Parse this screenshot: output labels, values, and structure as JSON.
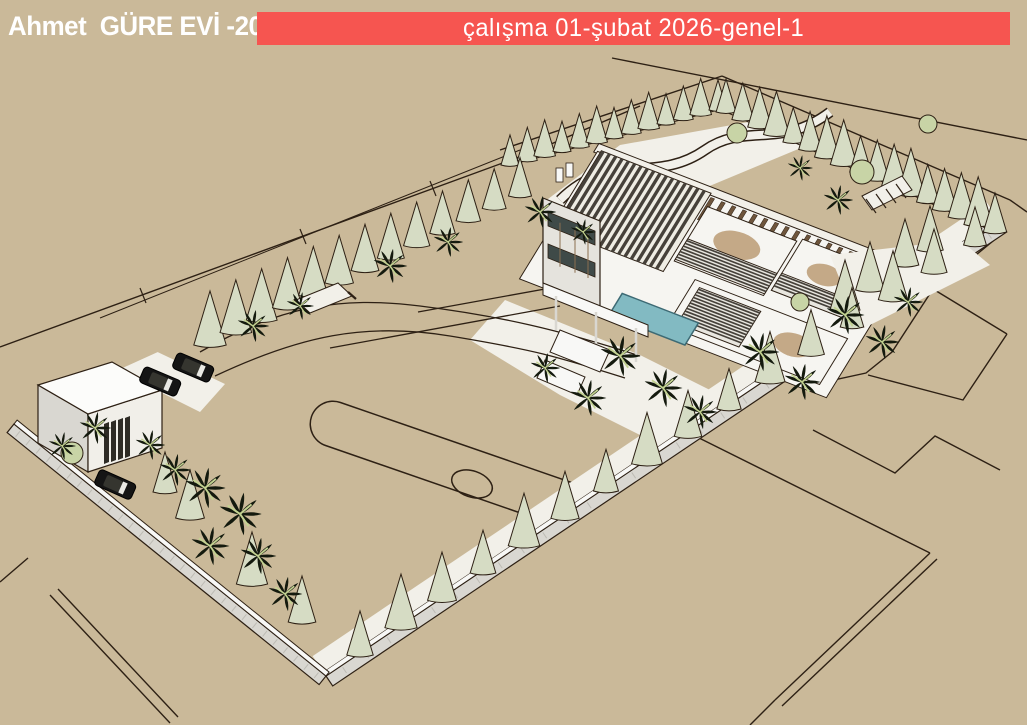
{
  "header": {
    "project_title": "Ahmet  GÜRE EVİ -2026",
    "sheet_title": "çalışma 01-şubat 2026-genel-1"
  },
  "colors": {
    "background": "#cab999",
    "banner_red": "#f65550",
    "line": "#2d2014",
    "wall_white": "#f8f8f6",
    "wall_shade": "#d9d7d1",
    "stone_tick": "#bdbbb4",
    "path_white": "#f2f0e9",
    "cypress": "#d6dcc4",
    "orchard_green": "#cdd8ac",
    "bush_green": "#c8d4a6",
    "palm_dark": "#141a0e",
    "palm_light": "#c3d291",
    "pool_teal": "#82bac2",
    "pool_edge": "#3d6a74",
    "roof_white": "#f6f5f1",
    "slat_dark": "#46413a",
    "fin_brown": "#6e553c",
    "blob_tan": "#c4a987",
    "car_dark": "#151515",
    "facade_gray": "#e5e3dd",
    "window_dark": "#3f4a48"
  },
  "scene": {
    "type": "3d-site-plan-render",
    "elements": [
      "villa-building",
      "pool",
      "pergola-roof",
      "perimeter-wall",
      "cypress-hedge",
      "orchard-grid",
      "palm-trees",
      "parking-cars",
      "gatehouse",
      "sports-field",
      "parcel-lines"
    ]
  }
}
